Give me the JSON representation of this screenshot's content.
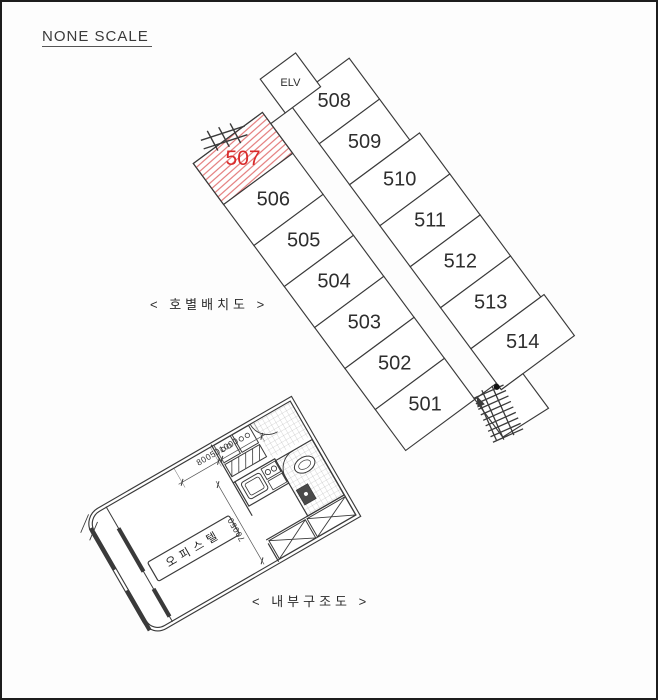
{
  "page": {
    "title": "NONE SCALE",
    "background": "#fdfdfd",
    "line_color": "#3a3a3a"
  },
  "unit_layout": {
    "caption": "< 호별배치도 >",
    "elevator_label": "ELV",
    "left_column_units": [
      "507",
      "506",
      "505",
      "504",
      "503",
      "502",
      "501"
    ],
    "right_column_units": [
      "508",
      "509",
      "510",
      "511",
      "512",
      "513",
      "514"
    ],
    "highlighted_unit": "507",
    "highlight_text_color": "#d92b2b",
    "highlight_hatch_color": "#e06a6a",
    "icons": {
      "stairs": "stairs-icon",
      "boundary_hatch": "survey-tick-icon"
    }
  },
  "interior_plan": {
    "caption": "< 내부구조도 >",
    "room_label": "오피스텔",
    "dim_width_label": "800501000",
    "dim_depth_label": "70050"
  }
}
